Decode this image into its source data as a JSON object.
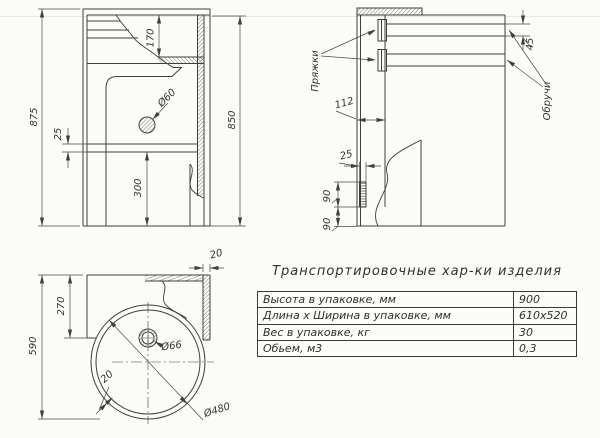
{
  "colors": {
    "ink": "#3f3f3f",
    "paper": "#fbfbf8"
  },
  "front": {
    "h_overall": "875",
    "h_box": "850",
    "inset_top": "170",
    "gap": "25",
    "bottom_len": "300",
    "hole_dia": "Ø60"
  },
  "side": {
    "offset": "112",
    "strip_w": "25",
    "seg_a": "90",
    "seg_b": "90",
    "band_w": "45",
    "buckles_label": "Пряжки",
    "hoops_label": "Обручи"
  },
  "top": {
    "depth": "590",
    "back_depth": "270",
    "edge_w": "20",
    "drain_dia": "Ø66",
    "rim_w": "20",
    "bowl_dia": "Ø480"
  },
  "table": {
    "title": "Транспортировочные хар-ки изделия",
    "rows": [
      {
        "label": "Высота в упаковке, мм",
        "value": "900"
      },
      {
        "label": "Длина х Ширина в упаковке, мм",
        "value": "610х520"
      },
      {
        "label": "Вес в упаковке, кг",
        "value": "30"
      },
      {
        "label": "Обьем, м3",
        "value": "0,3"
      }
    ]
  }
}
